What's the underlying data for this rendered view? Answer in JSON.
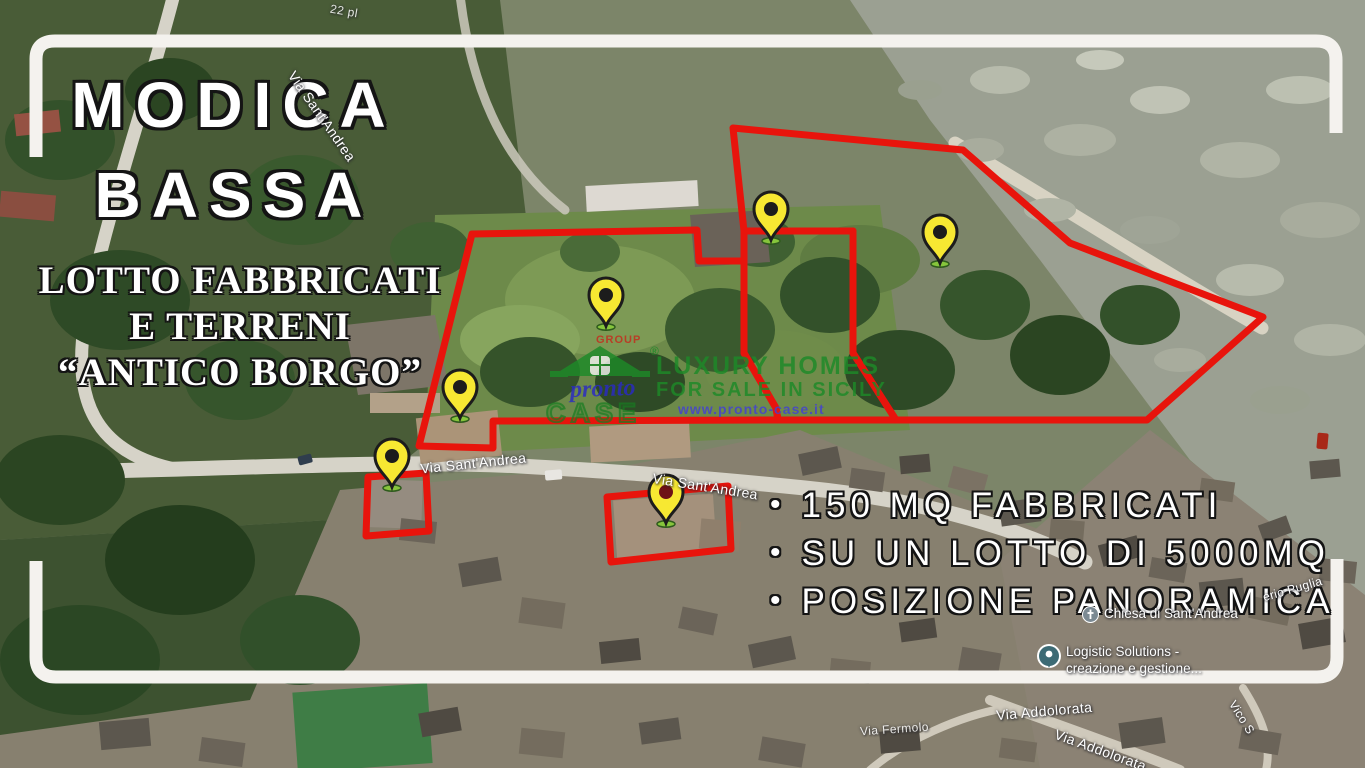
{
  "colors": {
    "boundary_red": "#e8140c",
    "pin_yellow": "#f7e832",
    "pin_base_green": "#86c53c",
    "frame_white": "#f4f2ee",
    "watermark_green": "#1d8a28",
    "watermark_blue": "#2a2ac4",
    "link_blue": "#4341d2",
    "group_red": "#c62a1c",
    "text_white": "#ffffff",
    "outline_black": "#141414"
  },
  "title": {
    "line1": "MODICA",
    "line2": "BASSA"
  },
  "subtitle": {
    "line1": "LOTTO FABBRICATI",
    "line2": "E TERRENI",
    "line3": "“ANTICO BORGO”"
  },
  "features": {
    "bullet": "•",
    "items": [
      "150 MQ FABBRICATI",
      "SU UN LOTTO DI 5000MQ",
      "POSIZIONE PANORAMICA"
    ]
  },
  "watermark": {
    "group_label": "GROUP",
    "registered_mark": "®",
    "script_word": "pronto",
    "brand_word": "CASE",
    "tagline_line1": "LUXURY HOMES",
    "tagline_line2": "FOR SALE IN SICILY",
    "website": "www.pronto-case.it"
  },
  "street_labels": {
    "via_sant_andrea_hill": "Via Sant'Andrea",
    "house_number_fragment": "22 pl",
    "via_sant_andrea_west": "Via Sant'Andrea",
    "via_sant_andrea_center": "Via Sant'Andrea",
    "saverio_puglia_fragment": "erio Puglia",
    "vico_fragment": "Vico S",
    "via_fermolo": "Via Fermolo",
    "via_addolorata_1": "Via Addolorata",
    "via_addolorata_2": "Via Addolorata"
  },
  "places": {
    "church_label": "Chiesa di Sant'Andrea",
    "business_line1": "Logistic Solutions -",
    "business_line2": "creazione e gestione..."
  },
  "markers": {
    "pin_count": 6,
    "parcel_outline_count": 3,
    "highlight_box_count": 2
  }
}
